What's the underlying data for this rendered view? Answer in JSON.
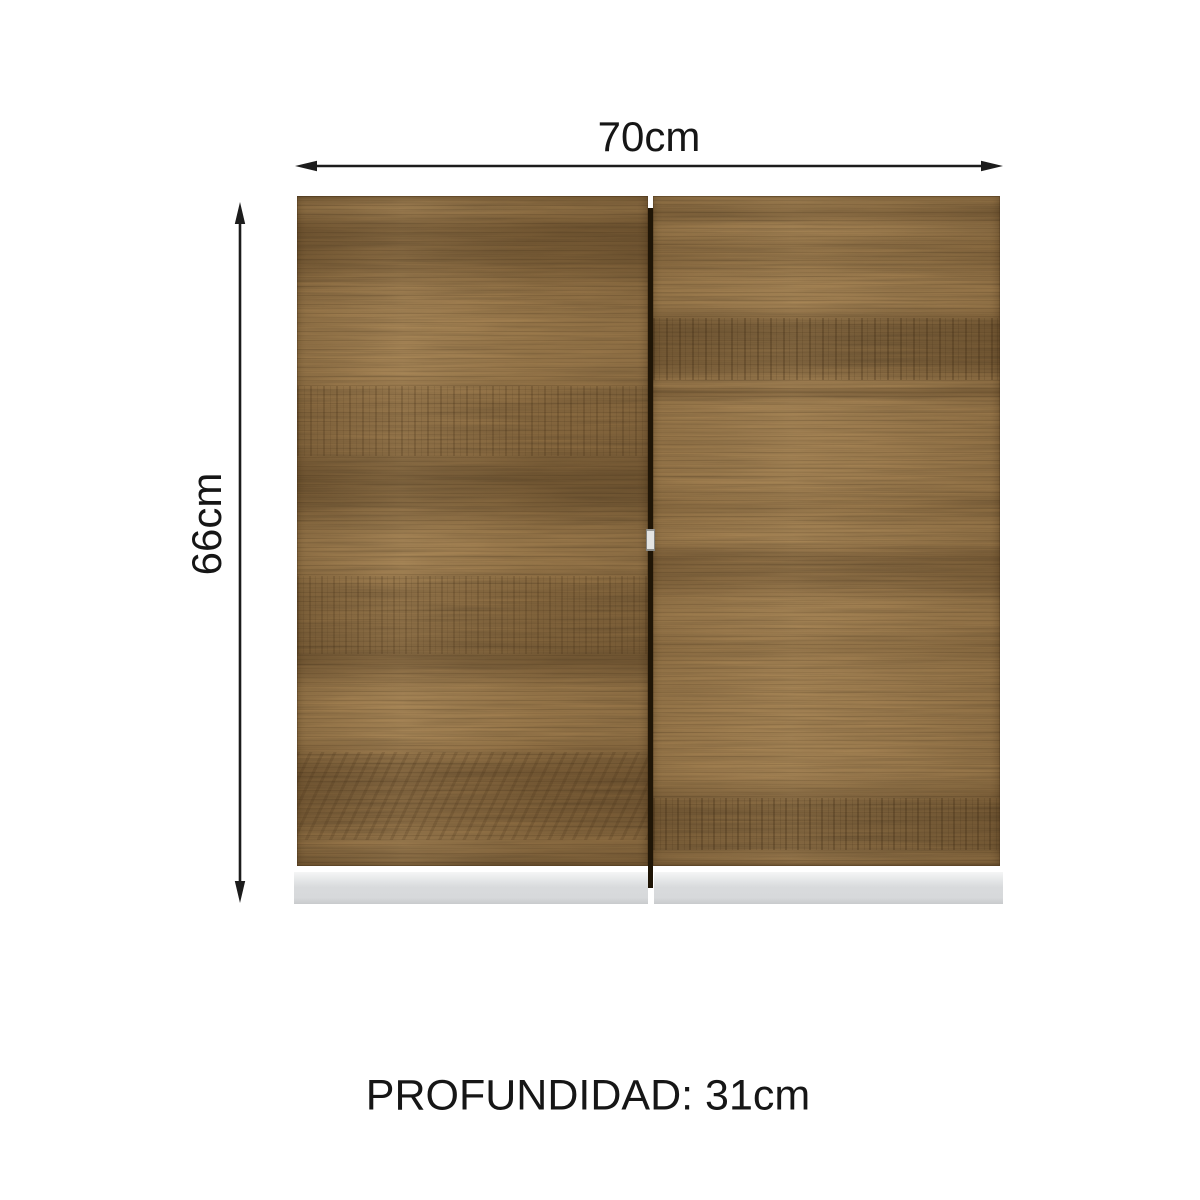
{
  "colors": {
    "bg": "#ffffff",
    "text": "#161616",
    "arrow": "#1c1c1c",
    "wood": "#a88452",
    "wood-dark": "#5a4021",
    "gap": "#1f1506",
    "base": "#d7d9db",
    "base-hi": "#f5f6f6",
    "catch": "#e4e4e2"
  },
  "dimensions": {
    "width_label": "70cm",
    "height_label": "66cm",
    "depth_label": "PROFUNDIDAD: 31cm"
  },
  "cabinet": {
    "doors": "2"
  }
}
